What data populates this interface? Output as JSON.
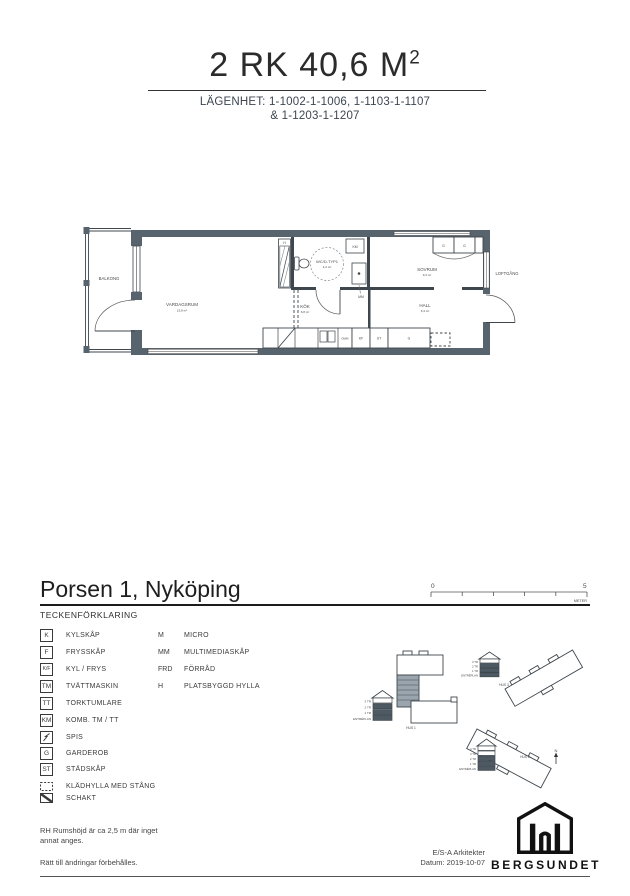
{
  "header": {
    "title_main": "2 RK 40,6 M",
    "title_sup": "2",
    "subtitle_line1": "LÄGENHET: 1-1002-1-1006, 1-1103-1-1107",
    "subtitle_line2": "& 1-1203-1-1207"
  },
  "floorplan": {
    "balcony": "BALKONG",
    "living": {
      "name": "VARDAGSRUM",
      "area": "15,8 m²"
    },
    "wc": {
      "name": "WC/D-TYP1",
      "area": "4,2 m²"
    },
    "kitchen": {
      "name": "KÖK",
      "area": "6,8 m²"
    },
    "bedroom": {
      "name": "SOVRUM",
      "area": "9,3 m²"
    },
    "hall": {
      "name": "HALL",
      "area": "6,4 m²"
    },
    "walkway": "LOFTGÅNG",
    "tags": {
      "km": "KM",
      "mm": "MM",
      "kf": "KF",
      "st": "ST",
      "g": "G",
      "g2": "G",
      "h": "H",
      "dm": "DM/M"
    }
  },
  "project": {
    "title": "Porsen 1, Nyköping",
    "legend_heading": "TECKENFÖRKLARING",
    "scale": {
      "zero": "0",
      "five": "5",
      "unit": "METER"
    }
  },
  "legend": {
    "col1": [
      {
        "sym": "K",
        "label": "KYLSKÅP"
      },
      {
        "sym": "F",
        "label": "FRYSSKÅP"
      },
      {
        "sym": "K/F",
        "label": "KYL / FRYS"
      },
      {
        "sym": "TM",
        "label": "TVÄTTMASKIN"
      },
      {
        "sym": "TT",
        "label": "TORKTUMLARE"
      },
      {
        "sym": "KM",
        "label": "KOMB. TM / TT"
      },
      {
        "sym": "",
        "label": "SPIS"
      },
      {
        "sym": "G",
        "label": "GARDEROB"
      },
      {
        "sym": "ST",
        "label": "STÄDSKÅP"
      },
      {
        "sym": "",
        "label": "KLÄDHYLLA  MED STÅNG"
      },
      {
        "sym": "",
        "label": "SCHAKT"
      }
    ],
    "col2": [
      {
        "sym": "M",
        "label": "MICRO"
      },
      {
        "sym": "MM",
        "label": "MULTIMEDIASKÅP"
      },
      {
        "sym": "FRD",
        "label": "FÖRRÅD"
      },
      {
        "sym": "H",
        "label": "PLATSBYGGD HYLLA"
      }
    ]
  },
  "siteplan": {
    "hus1": "HUS 1",
    "hus2": "HUS 2",
    "hus3": "HUS 3",
    "floors4": [
      "3 TR",
      "2 TR",
      "1 TR",
      "ENTRÉPLAN"
    ],
    "floors5": [
      "4 TR",
      "3 TR",
      "2 TR",
      "1 TR",
      "ENTRÉPLAN"
    ],
    "north": "N"
  },
  "footer": {
    "note_rh_1": "RH Rumshöjd är ca 2,5 m där inget",
    "note_rh_2": "annat anges.",
    "note_rights": "Rätt till ändringar förbehålles.",
    "architect": "E/S-A Arkitekter",
    "date": "Datum: 2019-10-07",
    "brand": "BERGSUNDET"
  },
  "colors": {
    "wall": "#57636d",
    "shaded_unit": "#9aa5ad",
    "ink": "#3f474e"
  }
}
